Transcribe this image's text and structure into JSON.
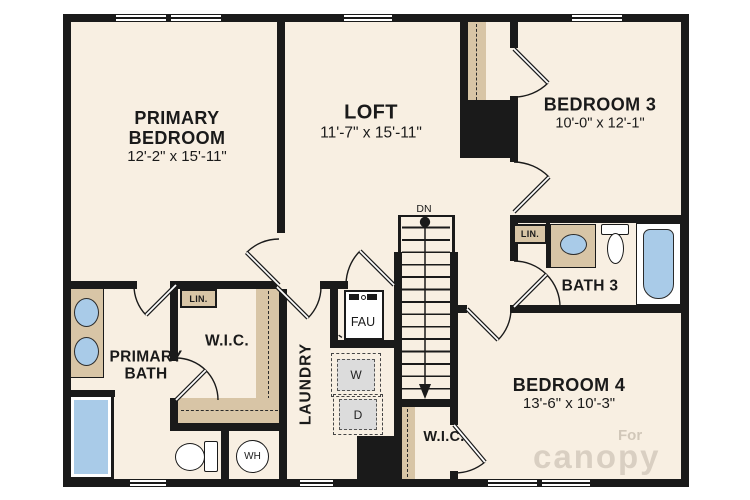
{
  "plan_title": "Second floor residential floor plan",
  "rooms": {
    "primary_bedroom": {
      "name": "PRIMARY BEDROOM",
      "dims": "12'-2\" x 15'-11\""
    },
    "loft": {
      "name": "LOFT",
      "dims": "11'-7\" x 15'-11\""
    },
    "bedroom_3": {
      "name": "BEDROOM 3",
      "dims": "10'-0\" x 12'-1\""
    },
    "bedroom_4": {
      "name": "BEDROOM 4",
      "dims": "13'-6\" x 10'-3\""
    },
    "bath_3": {
      "name": "BATH 3"
    },
    "primary_bath": {
      "name": "PRIMARY BATH"
    },
    "primary_wic": {
      "name": "W.I.C."
    },
    "bedroom_4_wic": {
      "name": "W.I.C."
    },
    "laundry": {
      "name": "LAUNDRY"
    }
  },
  "fixtures": {
    "fau": "FAU",
    "washer": "W",
    "dryer": "D",
    "water_heater": "WH",
    "linen_primary_wic": "LIN.",
    "linen_bath_3": "LIN."
  },
  "stairs": {
    "direction_label": "DN"
  },
  "watermark": {
    "line1": "For",
    "line2": "canopy"
  },
  "colors": {
    "floor": "#f8efe2",
    "wall": "#1a1a1a",
    "counter_tan": "#d8c5a6",
    "fixture_blue": "#a9cbe8",
    "appliance_gray": "#dcdcdc",
    "background": "#ffffff"
  }
}
